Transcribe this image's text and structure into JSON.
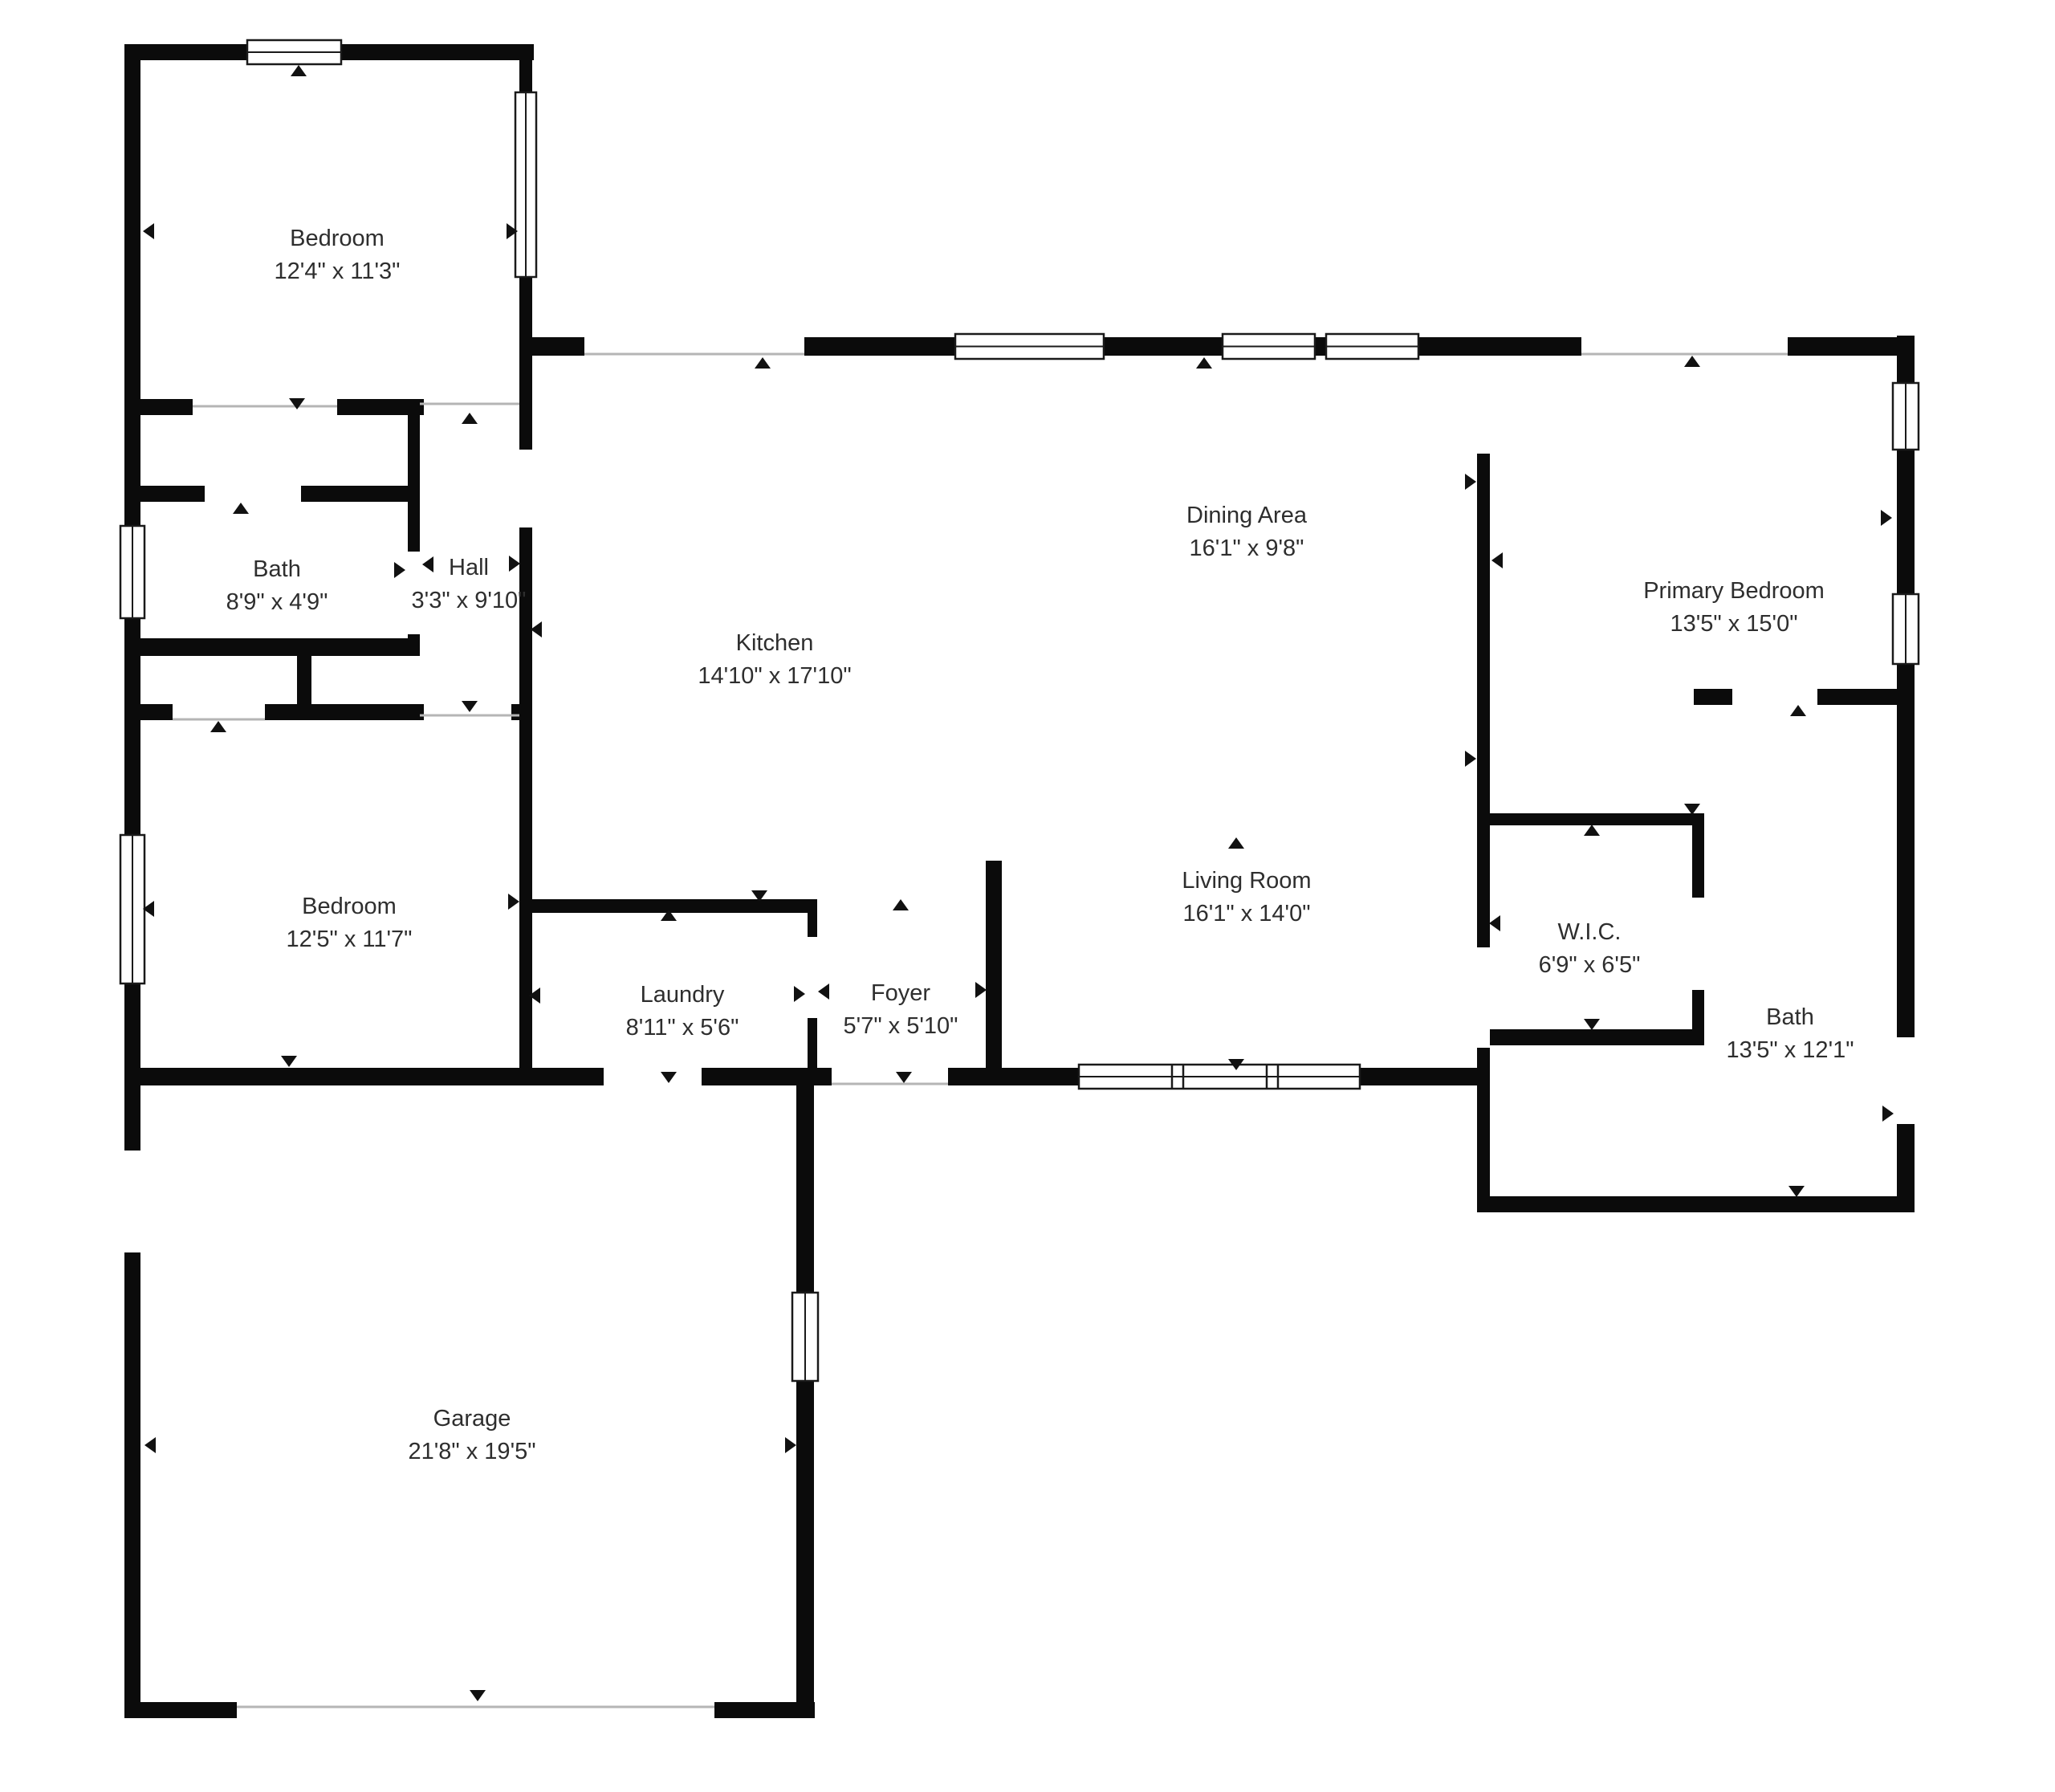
{
  "plan_title": "Floor plan",
  "colors": {
    "wall": "#0b0b0b",
    "background": "#ffffff",
    "text": "#2e2e2e",
    "sill": "#b5b5b5",
    "window_stroke": "#1a1a1a"
  },
  "rooms": {
    "bedroom1": {
      "name": "Bedroom",
      "dims": "12'4\" x 11'3\""
    },
    "bath_left": {
      "name": "Bath",
      "dims": "8'9\" x 4'9\""
    },
    "hall": {
      "name": "Hall",
      "dims": "3'3\" x 9'10\""
    },
    "kitchen": {
      "name": "Kitchen",
      "dims": "14'10\" x 17'10\""
    },
    "dining": {
      "name": "Dining Area",
      "dims": "16'1\" x 9'8\""
    },
    "living": {
      "name": "Living Room",
      "dims": "16'1\" x 14'0\""
    },
    "primary": {
      "name": "Primary Bedroom",
      "dims": "13'5\" x 15'0\""
    },
    "wic": {
      "name": "W.I.C.",
      "dims": "6'9\" x 6'5\""
    },
    "bath_right": {
      "name": "Bath",
      "dims": "13'5\" x 12'1\""
    },
    "foyer": {
      "name": "Foyer",
      "dims": "5'7\" x 5'10\""
    },
    "laundry": {
      "name": "Laundry",
      "dims": "8'11\" x 5'6\""
    },
    "bedroom2": {
      "name": "Bedroom",
      "dims": "12'5\" x 11'7\""
    },
    "garage": {
      "name": "Garage",
      "dims": "21'8\" x 19'5\""
    }
  }
}
